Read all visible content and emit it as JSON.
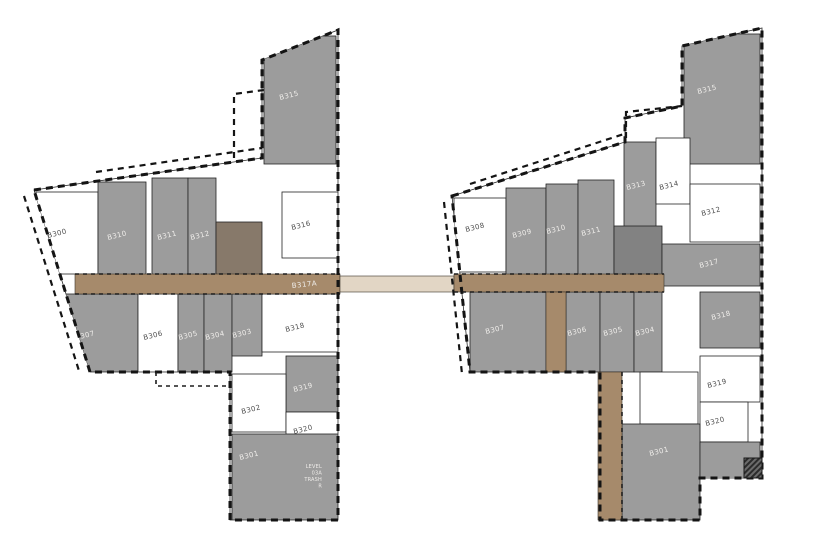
{
  "plan": {
    "title": "Level 3 floor plate diagram",
    "colors": {
      "paper": "#ffffff",
      "wall": "#1a1a1a",
      "unit_gray": "#9c9c9c",
      "core_gray": "#828282",
      "core_brown": "#87796a",
      "corridor_tan": "#a68a6b",
      "corridor_light": "#e2d6c5",
      "label_light": "#efedea",
      "label_dark": "#4f4f4f"
    },
    "rooms": [
      {
        "b": "L",
        "label": "B315",
        "x": 264,
        "y": 36,
        "w": 72,
        "h": 128,
        "fill": "gray",
        "lx": 280,
        "ly": 100,
        "lc": "light"
      },
      {
        "b": "L",
        "label": "B300",
        "x": 36,
        "y": 192,
        "w": 62,
        "h": 82,
        "fill": "white",
        "lx": 48,
        "ly": 238,
        "lc": "dark"
      },
      {
        "b": "L",
        "label": "B310",
        "x": 98,
        "y": 182,
        "w": 48,
        "h": 96,
        "fill": "gray",
        "lx": 108,
        "ly": 240,
        "lc": "light"
      },
      {
        "b": "L",
        "label": "B311",
        "x": 152,
        "y": 178,
        "w": 36,
        "h": 100,
        "fill": "gray",
        "lx": 158,
        "ly": 240,
        "lc": "light"
      },
      {
        "b": "L",
        "label": "B312",
        "x": 188,
        "y": 178,
        "w": 28,
        "h": 100,
        "fill": "gray",
        "lx": 191,
        "ly": 240,
        "lc": "light"
      },
      {
        "b": "L",
        "label": "",
        "x": 216,
        "y": 222,
        "w": 46,
        "h": 58,
        "fill": "corebrown",
        "lx": 0,
        "ly": 0,
        "lc": "light"
      },
      {
        "b": "L",
        "label": "B316",
        "x": 282,
        "y": 192,
        "w": 56,
        "h": 66,
        "fill": "white",
        "lx": 292,
        "ly": 230,
        "lc": "dark"
      },
      {
        "b": "L",
        "label": "B307",
        "x": 62,
        "y": 294,
        "w": 76,
        "h": 78,
        "fill": "gray",
        "lx": 76,
        "ly": 340,
        "lc": "light"
      },
      {
        "b": "L",
        "label": "B306",
        "x": 138,
        "y": 294,
        "w": 40,
        "h": 78,
        "fill": "white",
        "lx": 144,
        "ly": 340,
        "lc": "dark"
      },
      {
        "b": "L",
        "label": "B305",
        "x": 178,
        "y": 294,
        "w": 26,
        "h": 78,
        "fill": "gray",
        "lx": 179,
        "ly": 340,
        "lc": "light"
      },
      {
        "b": "L",
        "label": "B304",
        "x": 204,
        "y": 294,
        "w": 28,
        "h": 78,
        "fill": "gray",
        "lx": 206,
        "ly": 340,
        "lc": "light"
      },
      {
        "b": "L",
        "label": "B303",
        "x": 232,
        "y": 294,
        "w": 30,
        "h": 62,
        "fill": "gray",
        "lx": 233,
        "ly": 338,
        "lc": "light"
      },
      {
        "b": "L",
        "label": "B318",
        "x": 262,
        "y": 294,
        "w": 76,
        "h": 58,
        "fill": "white",
        "lx": 286,
        "ly": 332,
        "lc": "dark"
      },
      {
        "b": "L",
        "label": "B319",
        "x": 286,
        "y": 356,
        "w": 52,
        "h": 56,
        "fill": "gray",
        "lx": 294,
        "ly": 392,
        "lc": "light"
      },
      {
        "b": "L",
        "label": "B302",
        "x": 232,
        "y": 374,
        "w": 54,
        "h": 58,
        "fill": "white",
        "lx": 242,
        "ly": 414,
        "lc": "dark"
      },
      {
        "b": "L",
        "label": "B320",
        "x": 286,
        "y": 412,
        "w": 52,
        "h": 34,
        "fill": "white",
        "lx": 294,
        "ly": 434,
        "lc": "dark"
      },
      {
        "b": "L",
        "label": "B301",
        "x": 232,
        "y": 434,
        "w": 106,
        "h": 86,
        "fill": "gray",
        "lx": 240,
        "ly": 460,
        "lc": "light"
      },
      {
        "b": "R",
        "label": "B315",
        "x": 684,
        "y": 34,
        "w": 76,
        "h": 130,
        "fill": "gray",
        "lx": 698,
        "ly": 94,
        "lc": "light"
      },
      {
        "b": "R",
        "label": "B313",
        "x": 624,
        "y": 142,
        "w": 32,
        "h": 86,
        "fill": "gray",
        "lx": 627,
        "ly": 190,
        "lc": "light"
      },
      {
        "b": "R",
        "label": "B314",
        "x": 656,
        "y": 138,
        "w": 34,
        "h": 66,
        "fill": "white",
        "lx": 660,
        "ly": 190,
        "lc": "dark"
      },
      {
        "b": "R",
        "label": "B308",
        "x": 454,
        "y": 198,
        "w": 52,
        "h": 74,
        "fill": "white",
        "lx": 466,
        "ly": 232,
        "lc": "dark"
      },
      {
        "b": "R",
        "label": "B309",
        "x": 506,
        "y": 188,
        "w": 40,
        "h": 88,
        "fill": "gray",
        "lx": 513,
        "ly": 238,
        "lc": "light"
      },
      {
        "b": "R",
        "label": "B310",
        "x": 546,
        "y": 184,
        "w": 32,
        "h": 92,
        "fill": "gray",
        "lx": 547,
        "ly": 234,
        "lc": "light"
      },
      {
        "b": "R",
        "label": "B311",
        "x": 578,
        "y": 180,
        "w": 36,
        "h": 96,
        "fill": "gray",
        "lx": 582,
        "ly": 236,
        "lc": "light"
      },
      {
        "b": "R",
        "label": "",
        "x": 614,
        "y": 226,
        "w": 48,
        "h": 58,
        "fill": "core",
        "lx": 0,
        "ly": 0,
        "lc": "light"
      },
      {
        "b": "R",
        "label": "B312",
        "x": 690,
        "y": 184,
        "w": 70,
        "h": 58,
        "fill": "white",
        "lx": 702,
        "ly": 216,
        "lc": "dark"
      },
      {
        "b": "R",
        "label": "B317",
        "x": 662,
        "y": 244,
        "w": 98,
        "h": 42,
        "fill": "gray",
        "lx": 700,
        "ly": 268,
        "lc": "light"
      },
      {
        "b": "R",
        "label": "B307",
        "x": 470,
        "y": 292,
        "w": 76,
        "h": 80,
        "fill": "gray",
        "lx": 486,
        "ly": 334,
        "lc": "light"
      },
      {
        "b": "R",
        "label": "B306",
        "x": 566,
        "y": 292,
        "w": 34,
        "h": 80,
        "fill": "gray",
        "lx": 568,
        "ly": 336,
        "lc": "light"
      },
      {
        "b": "R",
        "label": "B305",
        "x": 600,
        "y": 292,
        "w": 34,
        "h": 80,
        "fill": "gray",
        "lx": 604,
        "ly": 336,
        "lc": "light"
      },
      {
        "b": "R",
        "label": "B304",
        "x": 634,
        "y": 292,
        "w": 28,
        "h": 80,
        "fill": "gray",
        "lx": 636,
        "ly": 336,
        "lc": "light"
      },
      {
        "b": "R",
        "label": "B318",
        "x": 700,
        "y": 292,
        "w": 60,
        "h": 56,
        "fill": "gray",
        "lx": 712,
        "ly": 320,
        "lc": "light"
      },
      {
        "b": "R",
        "label": "",
        "x": 640,
        "y": 372,
        "w": 58,
        "h": 52,
        "fill": "white",
        "lx": 0,
        "ly": 0,
        "lc": "dark"
      },
      {
        "b": "R",
        "label": "B319",
        "x": 700,
        "y": 356,
        "w": 60,
        "h": 46,
        "fill": "white",
        "lx": 708,
        "ly": 388,
        "lc": "dark"
      },
      {
        "b": "R",
        "label": "B320",
        "x": 700,
        "y": 402,
        "w": 48,
        "h": 40,
        "fill": "white",
        "lx": 706,
        "ly": 426,
        "lc": "dark"
      },
      {
        "b": "R",
        "label": "B301",
        "x": 622,
        "y": 424,
        "w": 78,
        "h": 96,
        "fill": "gray",
        "lx": 650,
        "ly": 456,
        "lc": "light"
      },
      {
        "b": "R",
        "label": "",
        "x": 700,
        "y": 442,
        "w": 60,
        "h": 38,
        "fill": "gray",
        "lx": 0,
        "ly": 0,
        "lc": "light"
      }
    ],
    "corridors": [
      {
        "x": 75,
        "y": 274,
        "w": 265,
        "h": 20,
        "fill": "tan"
      },
      {
        "x": 340,
        "y": 276,
        "w": 114,
        "h": 16,
        "fill": "light"
      },
      {
        "x": 454,
        "y": 274,
        "w": 210,
        "h": 18,
        "fill": "tan"
      },
      {
        "x": 546,
        "y": 292,
        "w": 20,
        "h": 80,
        "fill": "tan"
      },
      {
        "x": 598,
        "y": 372,
        "w": 24,
        "h": 148,
        "fill": "tan"
      }
    ],
    "corridor_labels": [
      {
        "text": "B317A",
        "x": 292,
        "y": 288,
        "rot": -6
      }
    ],
    "note": {
      "x": 322,
      "y": 468,
      "lines": [
        "LEVEL",
        "03A",
        "TRASH",
        "R"
      ]
    }
  }
}
